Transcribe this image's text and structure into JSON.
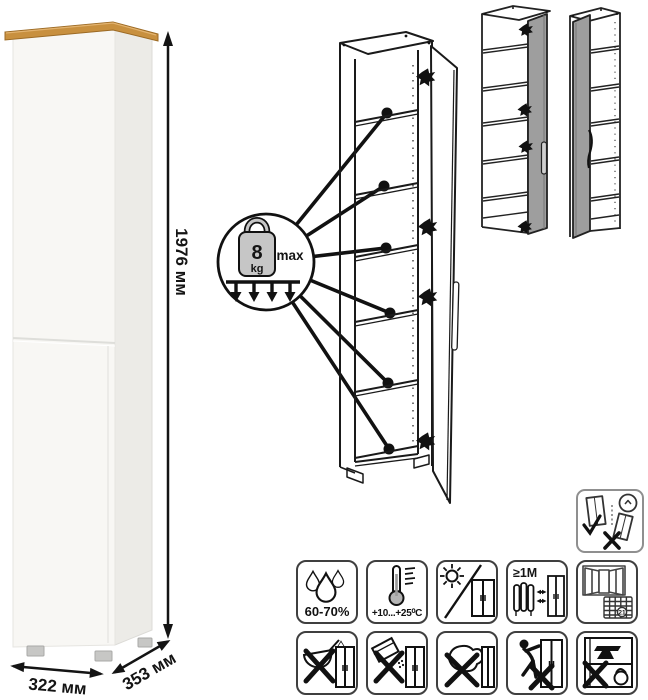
{
  "product": {
    "dimensions": {
      "height": "1976 мм",
      "width": "322 мм",
      "depth": "353 мм"
    },
    "shelf_load": {
      "value": "8",
      "unit": "kg",
      "qualifier": "max"
    },
    "colors": {
      "wood_top": "#c8903f",
      "body_white": "#f8f7f4",
      "side_shade": "#ecebe7",
      "door_gray": "#9e9e9e",
      "line_art": "#1a1a1a"
    }
  },
  "icons": {
    "wall_anchor": {
      "name": "anchor-to-wall-warning"
    },
    "care_row1": [
      {
        "name": "humidity-range",
        "label": "60-70%"
      },
      {
        "name": "temperature-range",
        "label": "+10...+25⁰C"
      },
      {
        "name": "no-direct-sunlight"
      },
      {
        "name": "keep-distance-from-heat",
        "label": "≥1М"
      },
      {
        "name": "ventilate-room",
        "calendar_day": "21"
      }
    ],
    "care_row2": [
      {
        "name": "no-liquids"
      },
      {
        "name": "no-abrasive-powders"
      },
      {
        "name": "no-wet-cloth"
      },
      {
        "name": "no-dragging"
      },
      {
        "name": "no-overloading"
      }
    ]
  }
}
